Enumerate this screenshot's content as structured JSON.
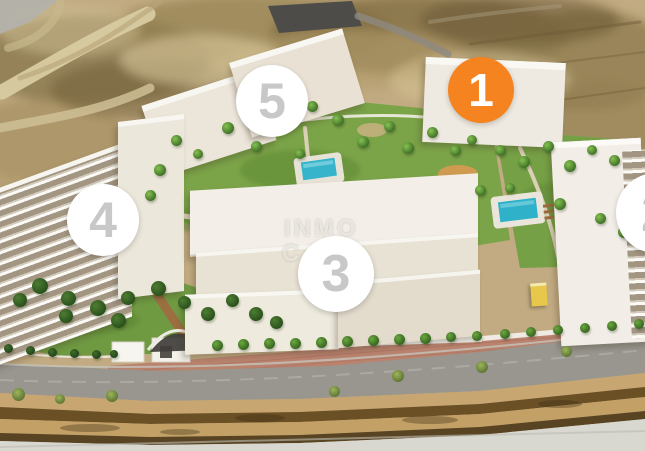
{
  "watermark": {
    "line1": "INMO",
    "line2": "C"
  },
  "badges": [
    {
      "id": "block-1",
      "label": "1",
      "state": "highlighted",
      "fill": "#f5831f",
      "number_color": "#ffffff"
    },
    {
      "id": "block-2",
      "label": "2",
      "state": "default",
      "fill": "#ffffff",
      "number_color": "#c8c8c8"
    },
    {
      "id": "block-3",
      "label": "3",
      "state": "default",
      "fill": "#ffffff",
      "number_color": "#c8c8c8"
    },
    {
      "id": "block-4",
      "label": "4",
      "state": "default",
      "fill": "#ffffff",
      "number_color": "#c8c8c8"
    },
    {
      "id": "block-5",
      "label": "5",
      "state": "default",
      "fill": "#ffffff",
      "number_color": "#c8c8c8"
    }
  ],
  "palette": {
    "accent_orange": "#f5831f",
    "badge_number_gray": "#c8c8c8",
    "terrain_sand": "#c2ab82",
    "lawn_green": "#7ba348",
    "pool_teal": "#2fb1c9",
    "road_gray": "#98968f"
  }
}
